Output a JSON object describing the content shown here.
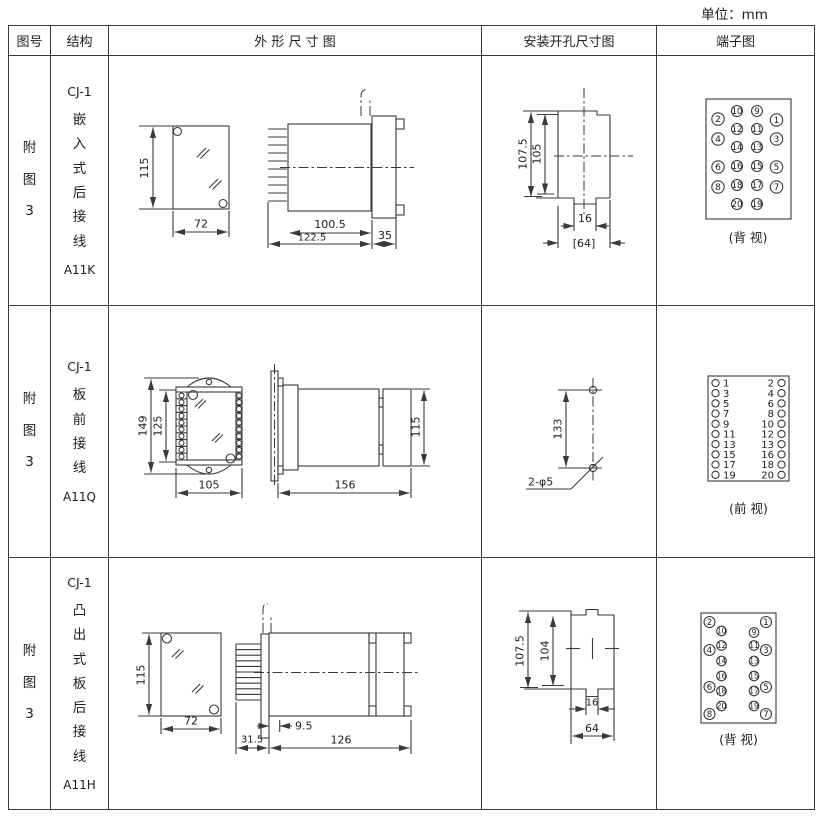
{
  "unit_note": "单位：mm",
  "headers": {
    "col1": "图号",
    "col2": "结构",
    "col3": "外 形 尺 寸 图",
    "col4": "安装开孔尺寸图",
    "col5": "端子图"
  },
  "rows": [
    {
      "figure_no": "附图3",
      "model": "CJ-1",
      "mounting_type": "嵌入式后接线",
      "code": "A11K",
      "outline_dims": {
        "height": "115",
        "width": "72",
        "body_depth": "100.5",
        "total_depth": "122.5",
        "flange_depth": "35"
      },
      "cutout_dims": {
        "v1": "107.5",
        "v2": "105",
        "h1": "16",
        "h2": "[64]"
      },
      "terminal": {
        "view_label": "(背 视)",
        "inner_left": [
          "10",
          "12",
          "14",
          "16",
          "18",
          "20"
        ],
        "inner_right": [
          "9",
          "11",
          "13",
          "15",
          "17",
          "19"
        ],
        "outer_left": [
          "2",
          "4",
          "6",
          "8"
        ],
        "outer_right": [
          "1",
          "3",
          "5",
          "7"
        ]
      }
    },
    {
      "figure_no": "附图3",
      "model": "CJ-1",
      "mounting_type": "板前接线",
      "code": "A11Q",
      "outline_dims": {
        "height_outer": "149",
        "height_inner": "125",
        "width": "105",
        "depth": "156",
        "height_rear": "115"
      },
      "cutout_dims": {
        "spacing": "133",
        "holes": "2-φ5"
      },
      "terminal": {
        "view_label": "(前 视)",
        "left": [
          "1",
          "3",
          "5",
          "7",
          "9",
          "11",
          "13",
          "15",
          "17",
          "19"
        ],
        "right": [
          "2",
          "4",
          "6",
          "8",
          "10",
          "12",
          "13",
          "16",
          "18",
          "20"
        ]
      }
    },
    {
      "figure_no": "附图3",
      "model": "CJ-1",
      "mounting_type": "凸出式板后接线",
      "code": "A11H",
      "outline_dims": {
        "height": "115",
        "width": "72",
        "pin_depth": "31.5",
        "panel_gap": "9.5",
        "depth": "126"
      },
      "cutout_dims": {
        "v1": "107.5",
        "v2": "104",
        "h1": "16",
        "h2": "64"
      },
      "terminal": {
        "view_label": "(背 视)",
        "inner_left": [
          "10",
          "12",
          "14",
          "16",
          "18",
          "20"
        ],
        "inner_right": [
          "9",
          "11",
          "13",
          "15",
          "17",
          "19"
        ],
        "outer_left": [
          "2",
          "4",
          "6",
          "8"
        ],
        "outer_right": [
          "1",
          "3",
          "5",
          "7"
        ]
      }
    }
  ]
}
